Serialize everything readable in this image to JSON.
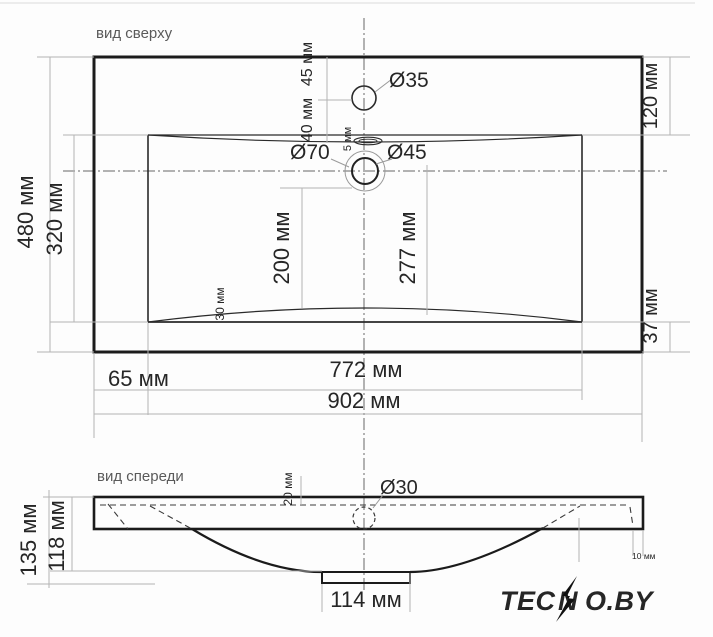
{
  "top_view": {
    "label": "вид сверху",
    "dims": {
      "faucet_diameter": "Ø35",
      "faucet_offset_top": "45 мм",
      "faucet_to_basin": "40 мм",
      "overflow_slot": "5 мм",
      "drain_outer_diameter": "Ø70",
      "drain_inner_diameter": "Ø45",
      "right_top_offset": "120 мм",
      "depth_overall": "480 мм",
      "depth_basin": "320 мм",
      "drain_to_front": "200 мм",
      "center_to_front": "277 мм",
      "front_lip": "30 мм",
      "right_bottom_offset": "37 мм",
      "left_offset": "65 мм",
      "basin_width": "772 мм",
      "overall_width": "902 мм"
    }
  },
  "front_view": {
    "label": "вид спереди",
    "dims": {
      "overflow_diameter": "Ø30",
      "top_inset": "20 мм",
      "height_overall": "135 мм",
      "height_basin": "118 мм",
      "edge_inset": "10 мм",
      "drain_width": "114 мм"
    }
  },
  "watermark": {
    "part1": "TEC",
    "part2": "N",
    "part3": "O.BY",
    "color": "#f5821f"
  },
  "colors": {
    "outline": "#1b1b1b",
    "dimension_line": "#b3b3b3",
    "text": "#262626",
    "muted_text": "#5a5a5a",
    "watermark": "#f5821f"
  }
}
